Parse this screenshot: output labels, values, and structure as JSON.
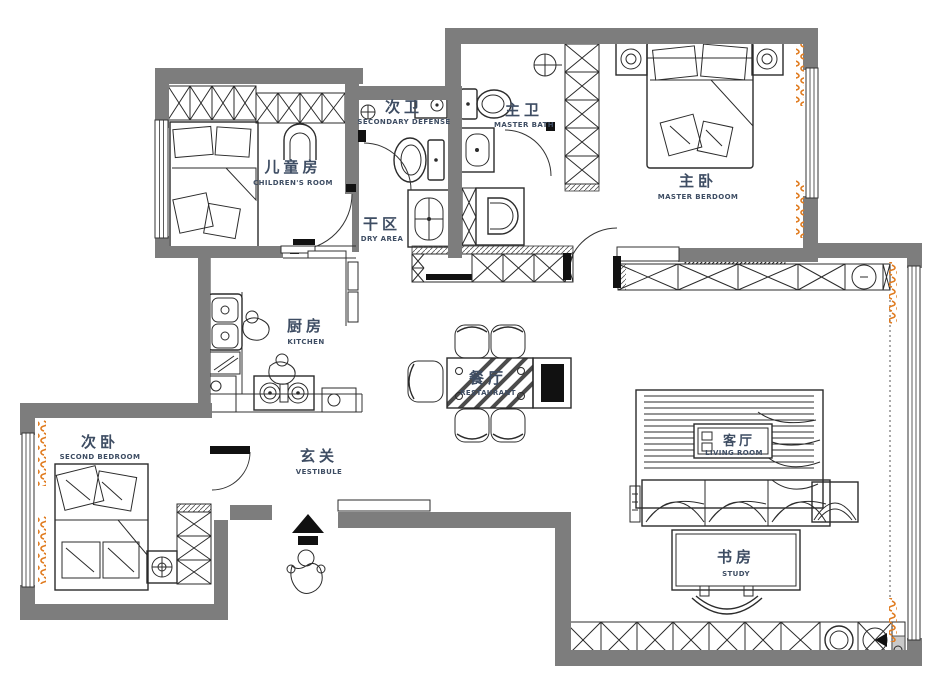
{
  "plan_title": "apartment-floor-plan",
  "colors": {
    "wall": "#7d7d7d",
    "line": "#2b2b2b",
    "label": "#3e4d63",
    "curtain": "#e07b1f",
    "background": "#ffffff",
    "accent_black": "#111111"
  },
  "rooms": [
    {
      "id": "children-room",
      "zh": "儿童房",
      "en": "CHILDREN'S ROOM"
    },
    {
      "id": "secondary-bath",
      "zh": "次卫",
      "en": "SECONDARY DEFENSE"
    },
    {
      "id": "dry-area",
      "zh": "干区",
      "en": "DRY AREA"
    },
    {
      "id": "master-bath",
      "zh": "主卫",
      "en": "MASTER BATH"
    },
    {
      "id": "master-bedroom",
      "zh": "主卧",
      "en": "MASTER BERDOOM"
    },
    {
      "id": "kitchen",
      "zh": "厨房",
      "en": "KITCHEN"
    },
    {
      "id": "dining-room",
      "zh": "餐厅",
      "en": "RESTAURANT"
    },
    {
      "id": "living-room",
      "zh": "客厅",
      "en": "LIVING ROOM"
    },
    {
      "id": "study",
      "zh": "书房",
      "en": "STUDY"
    },
    {
      "id": "vestibule",
      "zh": "玄关",
      "en": "VESTIBULE"
    },
    {
      "id": "second-bedroom",
      "zh": "次卧",
      "en": "SECOND BEDROOM"
    }
  ]
}
